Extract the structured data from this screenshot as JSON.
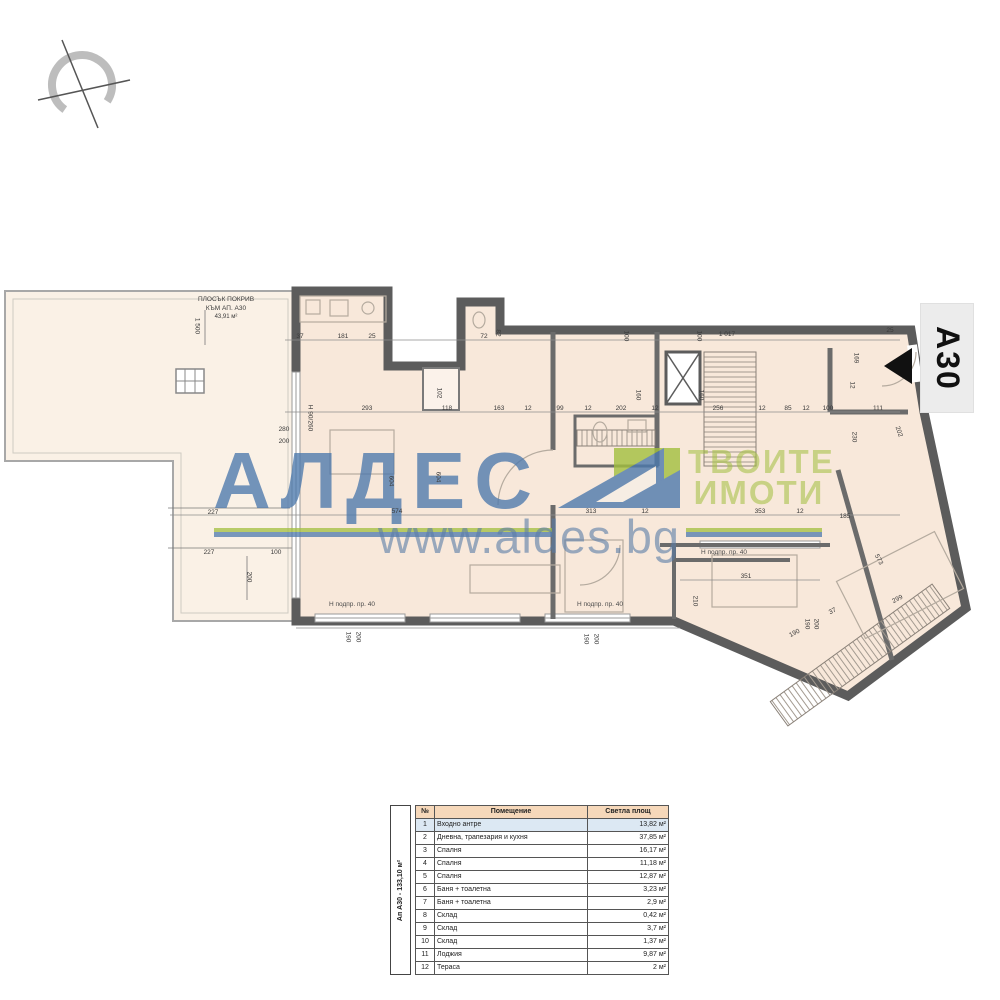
{
  "colors": {
    "wall": "#5c5c5c",
    "floor": "#f8e8da",
    "terrace_floor": "#faf1e6",
    "brand_blue": "#4d79ad",
    "brand_green": "#a2bf3e",
    "table_header_bg": "#f6d8ba",
    "table_highlight_bg": "#dce8f3"
  },
  "compass": {
    "name": "north-orientation-symbol"
  },
  "unit_tag": {
    "text": "А30"
  },
  "roof_note": {
    "line1": "ПЛОСЪК ПОКРИВ",
    "line2": "КЪМ АП. А30",
    "line3": "43,91 м²"
  },
  "watermark": {
    "brand": "АЛДЕС",
    "tagline_line1": "ТВОИТЕ",
    "tagline_line2": "ИМОТИ",
    "url": "www.aldes.bg"
  },
  "plan": {
    "dimensions": [
      {
        "t": "37",
        "x": 300,
        "y": 337
      },
      {
        "t": "181",
        "x": 343,
        "y": 337
      },
      {
        "t": "25",
        "x": 372,
        "y": 337
      },
      {
        "t": "72",
        "x": 484,
        "y": 337
      },
      {
        "t": "82",
        "x": 497,
        "y": 333,
        "r": 90
      },
      {
        "t": "100",
        "x": 625,
        "y": 336,
        "r": 90
      },
      {
        "t": "100",
        "x": 698,
        "y": 336,
        "r": 90
      },
      {
        "t": "1 017",
        "x": 727,
        "y": 335
      },
      {
        "t": "25",
        "x": 890,
        "y": 331
      },
      {
        "t": "169",
        "x": 855,
        "y": 358,
        "r": 90
      },
      {
        "t": "12",
        "x": 851,
        "y": 385,
        "r": 90
      },
      {
        "t": "293",
        "x": 367,
        "y": 409
      },
      {
        "t": "118",
        "x": 447,
        "y": 409
      },
      {
        "t": "163",
        "x": 499,
        "y": 409
      },
      {
        "t": "12",
        "x": 528,
        "y": 409
      },
      {
        "t": "99",
        "x": 560,
        "y": 409
      },
      {
        "t": "12",
        "x": 588,
        "y": 409
      },
      {
        "t": "202",
        "x": 621,
        "y": 409
      },
      {
        "t": "12",
        "x": 655,
        "y": 409
      },
      {
        "t": "256",
        "x": 718,
        "y": 409
      },
      {
        "t": "12",
        "x": 762,
        "y": 409
      },
      {
        "t": "85",
        "x": 788,
        "y": 409
      },
      {
        "t": "12",
        "x": 806,
        "y": 409
      },
      {
        "t": "100",
        "x": 828,
        "y": 409
      },
      {
        "t": "111",
        "x": 878,
        "y": 409
      },
      {
        "t": "102",
        "x": 438,
        "y": 393,
        "r": 90
      },
      {
        "t": "160",
        "x": 637,
        "y": 395,
        "r": 90
      },
      {
        "t": "160",
        "x": 700,
        "y": 395,
        "r": 90
      },
      {
        "t": "1 500",
        "x": 196,
        "y": 326,
        "r": 90
      },
      {
        "t": "280",
        "x": 284,
        "y": 430
      },
      {
        "t": "200",
        "x": 284,
        "y": 442
      },
      {
        "t": "227",
        "x": 213,
        "y": 513
      },
      {
        "t": "227",
        "x": 209,
        "y": 553
      },
      {
        "t": "100",
        "x": 276,
        "y": 553
      },
      {
        "t": "200",
        "x": 248,
        "y": 577,
        "r": 90
      },
      {
        "t": "Н 90/260",
        "x": 309,
        "y": 418,
        "r": 90
      },
      {
        "t": "574",
        "x": 397,
        "y": 512
      },
      {
        "t": "604",
        "x": 390,
        "y": 481,
        "r": 90
      },
      {
        "t": "604",
        "x": 437,
        "y": 477,
        "r": 90
      },
      {
        "t": "313",
        "x": 591,
        "y": 512
      },
      {
        "t": "12",
        "x": 645,
        "y": 512
      },
      {
        "t": "353",
        "x": 760,
        "y": 512
      },
      {
        "t": "12",
        "x": 800,
        "y": 512
      },
      {
        "t": "185",
        "x": 845,
        "y": 517
      },
      {
        "t": "230",
        "x": 853,
        "y": 437,
        "r": 90
      },
      {
        "t": "202",
        "x": 898,
        "y": 432,
        "r": 70
      },
      {
        "t": "351",
        "x": 746,
        "y": 577
      },
      {
        "t": "210",
        "x": 694,
        "y": 601,
        "r": 90
      },
      {
        "t": "190",
        "x": 795,
        "y": 634,
        "r": -28
      },
      {
        "t": "299",
        "x": 898,
        "y": 600,
        "r": -28
      },
      {
        "t": "573",
        "x": 878,
        "y": 560,
        "r": 62
      },
      {
        "t": "37",
        "x": 833,
        "y": 612,
        "r": -28
      },
      {
        "t": "190",
        "x": 806,
        "y": 624,
        "r": 90
      },
      {
        "t": "200",
        "x": 815,
        "y": 624,
        "r": 90
      },
      {
        "t": "190",
        "x": 347,
        "y": 637,
        "r": 90
      },
      {
        "t": "200",
        "x": 357,
        "y": 637,
        "r": 90
      },
      {
        "t": "190",
        "x": 585,
        "y": 639,
        "r": 90
      },
      {
        "t": "200",
        "x": 595,
        "y": 639,
        "r": 90
      },
      {
        "t": "Н подпр. пр. 40",
        "x": 352,
        "y": 605,
        "cls": "note"
      },
      {
        "t": "Н подпр. пр. 40",
        "x": 600,
        "y": 605,
        "cls": "note"
      },
      {
        "t": "Н подпр. пр. 40",
        "x": 724,
        "y": 553,
        "cls": "note"
      }
    ]
  },
  "table": {
    "vertical_label": "Ап А30 - 133,10 м²",
    "headers": [
      "№",
      "Помещение",
      "Светла площ"
    ],
    "rows": [
      [
        "1",
        "Входно антре",
        "13,82 м²"
      ],
      [
        "2",
        "Дневна, трапезария и кухня",
        "37,85 м²"
      ],
      [
        "3",
        "Спалня",
        "16,17 м²"
      ],
      [
        "4",
        "Спалня",
        "11,18 м²"
      ],
      [
        "5",
        "Спалня",
        "12,87 м²"
      ],
      [
        "6",
        "Баня + тоалетна",
        "3,23 м²"
      ],
      [
        "7",
        "Баня + тоалетна",
        "2,9 м²"
      ],
      [
        "8",
        "Склад",
        "0,42 м²"
      ],
      [
        "9",
        "Склад",
        "3,7 м²"
      ],
      [
        "10",
        "Склад",
        "1,37 м²"
      ],
      [
        "11",
        "Лоджия",
        "9,87 м²"
      ],
      [
        "12",
        "Тераса",
        "2 м²"
      ]
    ]
  }
}
